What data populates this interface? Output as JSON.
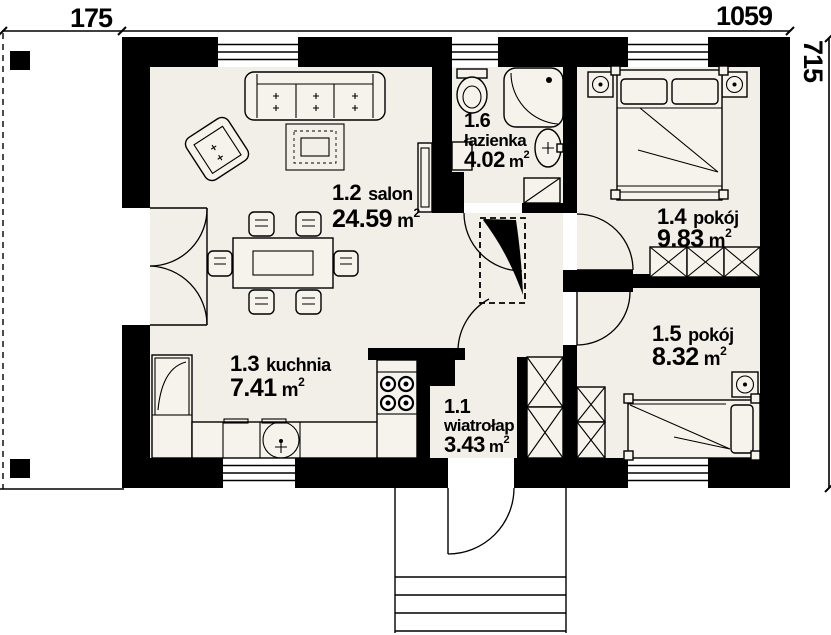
{
  "drawing": {
    "type": "floor-plan",
    "dimensions": {
      "top_left": "175",
      "top_right": "1059",
      "right": "715"
    },
    "unit": {
      "symbol": "m",
      "sup": "2"
    },
    "rooms": [
      {
        "number": "1.1",
        "name": "wiatrołap",
        "area": "3.43"
      },
      {
        "number": "1.2",
        "name": "salon",
        "area": "24.59"
      },
      {
        "number": "1.3",
        "name": "kuchnia",
        "area": "7.41"
      },
      {
        "number": "1.4",
        "name": "pokój",
        "area": "9.83"
      },
      {
        "number": "1.5",
        "name": "pokój",
        "area": "8.32"
      },
      {
        "number": "1.6",
        "name": "łazienka",
        "area": "4.02"
      }
    ],
    "colors": {
      "wall": "#000000",
      "floor": "#f2efe8",
      "outside": "#ffffff"
    }
  }
}
